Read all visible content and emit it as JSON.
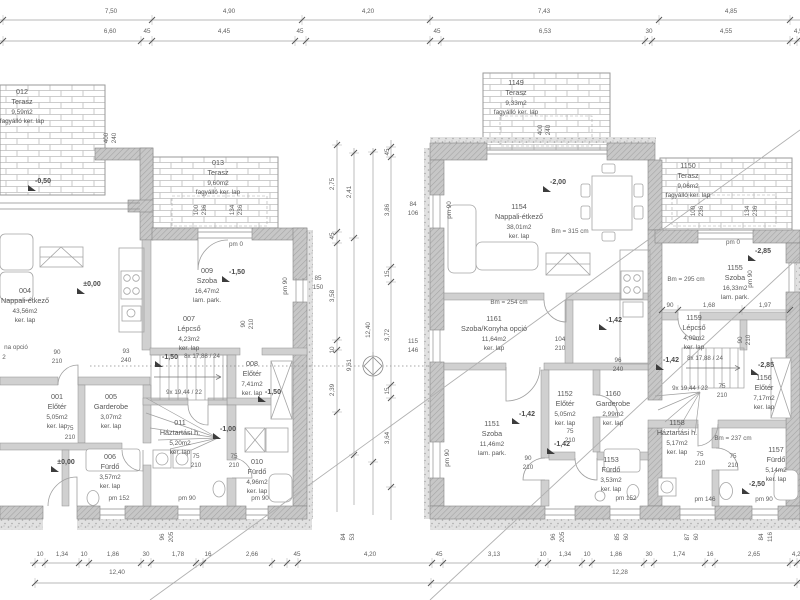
{
  "drawing_type": "architectural floor plan, two semi-detached houses, ground floor",
  "colors": {
    "paper": "#ffffff",
    "line": "#a0a0a0",
    "wall_fill": "#c9c9c9",
    "text": "#5f5f5f",
    "accent": "#3c3c3c"
  },
  "rooms": [
    {
      "id": "012",
      "name": "Terasz",
      "area": "9,59m2",
      "floor": "fagyálló ker. lap",
      "cx": 22,
      "y": 87
    },
    {
      "id": "013",
      "name": "Terasz",
      "area": "9,60m2",
      "floor": "fagyálló ker. lap",
      "cx": 218,
      "y": 158
    },
    {
      "id": "004",
      "name": "Nappali-étkező",
      "area": "43,56m2",
      "floor": "ker. lap",
      "cx": 25,
      "y": 286
    },
    {
      "id": "009",
      "name": "Szoba",
      "area": "16,47m2",
      "floor": "lam. park.",
      "cx": 207,
      "y": 266
    },
    {
      "id": "007",
      "name": "Lépcső",
      "area": "4,23m2",
      "floor": "ker. lap",
      "cx": 189,
      "y": 314
    },
    {
      "id": "008",
      "name": "Előtér",
      "area": "7,41m2",
      "floor": "ker. lap",
      "cx": 252,
      "y": 359
    },
    {
      "id": "001",
      "name": "Előtér",
      "area": "5,05m2",
      "floor": "ker. lap",
      "cx": 57,
      "y": 392
    },
    {
      "id": "005",
      "name": "Garderobe",
      "area": "3,07m2",
      "floor": "ker. lap",
      "cx": 111,
      "y": 392
    },
    {
      "id": "011",
      "name": "Háztartási h.",
      "area": "5,20m2",
      "floor": "ker. lap",
      "cx": 180,
      "y": 418
    },
    {
      "id": "006",
      "name": "Fürdő",
      "area": "3,57m2",
      "floor": "ker. lap",
      "cx": 110,
      "y": 452
    },
    {
      "id": "010",
      "name": "Fürdő",
      "area": "4,96m2",
      "floor": "ker. lap",
      "cx": 257,
      "y": 457
    },
    {
      "id": "1149",
      "name": "Terasz",
      "area": "9,33m2",
      "floor": "fagyálló ker. lap",
      "cx": 516,
      "y": 78
    },
    {
      "id": "1150",
      "name": "Terasz",
      "area": "9,06m2",
      "floor": "fagyálló ker. lap",
      "cx": 688,
      "y": 161
    },
    {
      "id": "1154",
      "name": "Nappali-étkező",
      "area": "38,01m2",
      "floor": "ker. lap",
      "cx": 519,
      "y": 202
    },
    {
      "id": "1161",
      "name": "Szoba/Konyha opció",
      "area": "11,64m2",
      "floor": "ker. lap",
      "cx": 494,
      "y": 314
    },
    {
      "id": "1151",
      "name": "Szoba",
      "area": "11,46m2",
      "floor": "lam. park.",
      "cx": 492,
      "y": 419
    },
    {
      "id": "1152",
      "name": "Előtér",
      "area": "5,05m2",
      "floor": "ker. lap",
      "cx": 565,
      "y": 389
    },
    {
      "id": "1160",
      "name": "Garderobe",
      "area": "2,99m2",
      "floor": "ker. lap",
      "cx": 613,
      "y": 389
    },
    {
      "id": "1153",
      "name": "Fürdő",
      "area": "3,53m2",
      "floor": "ker. lap",
      "cx": 611,
      "y": 455
    },
    {
      "id": "1155",
      "name": "Szoba",
      "area": "16,33m2",
      "floor": "lam. park.",
      "cx": 735,
      "y": 263
    },
    {
      "id": "1159",
      "name": "Lépcső",
      "area": "4,09m2",
      "floor": "ker. lap",
      "cx": 694,
      "y": 313
    },
    {
      "id": "1156",
      "name": "Előtér",
      "area": "7,17m2",
      "floor": "ker. lap",
      "cx": 764,
      "y": 373
    },
    {
      "id": "1158",
      "name": "Háztartási h.",
      "area": "5,17m2",
      "floor": "ker. lap",
      "cx": 677,
      "y": 418
    },
    {
      "id": "1157",
      "name": "Fürdő",
      "area": "5,14m2",
      "floor": "ker. lap",
      "cx": 776,
      "y": 445
    }
  ],
  "levels": [
    {
      "v": "-0,50",
      "x": 43,
      "y": 178
    },
    {
      "v": "±0,00",
      "x": 92,
      "y": 281
    },
    {
      "v": "-1,50",
      "x": 237,
      "y": 269
    },
    {
      "v": "-1,50",
      "x": 170,
      "y": 354
    },
    {
      "v": "-1,50",
      "x": 273,
      "y": 389
    },
    {
      "v": "-1,00",
      "x": 228,
      "y": 426
    },
    {
      "v": "±0,00",
      "x": 66,
      "y": 459
    },
    {
      "v": "-2,00",
      "x": 558,
      "y": 179
    },
    {
      "v": "-1,42",
      "x": 527,
      "y": 411
    },
    {
      "v": "-1,42",
      "x": 614,
      "y": 317
    },
    {
      "v": "-1,42",
      "x": 562,
      "y": 441
    },
    {
      "v": "-1,42",
      "x": 671,
      "y": 357
    },
    {
      "v": "-2,85",
      "x": 763,
      "y": 248
    },
    {
      "v": "-2,85",
      "x": 766,
      "y": 362
    },
    {
      "v": "-2,50",
      "x": 757,
      "y": 481
    }
  ],
  "dim_top1": {
    "y": 9,
    "items": [
      {
        "t": "7,50",
        "x": 111
      },
      {
        "t": "4,90",
        "x": 229
      },
      {
        "t": "4,20",
        "x": 368
      },
      {
        "t": "7,43",
        "x": 544
      },
      {
        "t": "4,85",
        "x": 731
      }
    ]
  },
  "dim_top2": {
    "y": 29,
    "items": [
      {
        "t": "6,60",
        "x": 110
      },
      {
        "t": "45",
        "x": 147
      },
      {
        "t": "4,45",
        "x": 224
      },
      {
        "t": "45",
        "x": 300
      },
      {
        "t": "45",
        "x": 437
      },
      {
        "t": "6,53",
        "x": 545
      },
      {
        "t": "30",
        "x": 649
      },
      {
        "t": "4,55",
        "x": 726
      },
      {
        "t": "4,55",
        "x": 800
      }
    ]
  },
  "dim_bottom": {
    "y": 552,
    "items": [
      {
        "t": "10",
        "x": 40
      },
      {
        "t": "1,34",
        "x": 62
      },
      {
        "t": "10",
        "x": 84
      },
      {
        "t": "1,86",
        "x": 113
      },
      {
        "t": "30",
        "x": 146
      },
      {
        "t": "1,78",
        "x": 178
      },
      {
        "t": "16",
        "x": 208
      },
      {
        "t": "2,66",
        "x": 252
      },
      {
        "t": "45",
        "x": 297
      },
      {
        "t": "4,20",
        "x": 370
      },
      {
        "t": "45",
        "x": 439
      },
      {
        "t": "3,13",
        "x": 494
      },
      {
        "t": "10",
        "x": 543
      },
      {
        "t": "1,34",
        "x": 565
      },
      {
        "t": "10",
        "x": 587
      },
      {
        "t": "1,86",
        "x": 616
      },
      {
        "t": "30",
        "x": 649
      },
      {
        "t": "1,74",
        "x": 679
      },
      {
        "t": "16",
        "x": 710
      },
      {
        "t": "2,65",
        "x": 754
      },
      {
        "t": "4,20",
        "x": 798
      }
    ]
  },
  "dim_totals": [
    {
      "t": "12,40",
      "x": 117,
      "y": 570
    },
    {
      "t": "12,28",
      "x": 620,
      "y": 570
    }
  ],
  "v_chains": [
    {
      "x": 333,
      "items": [
        {
          "t": "2,75",
          "y": 184
        },
        {
          "t": "45",
          "y": 236
        },
        {
          "t": "3,58",
          "y": 296
        },
        {
          "t": "10",
          "y": 350
        },
        {
          "t": "2,39",
          "y": 390
        }
      ]
    },
    {
      "x": 350,
      "items": [
        {
          "t": "2,41",
          "y": 192
        },
        {
          "t": "9,61",
          "y": 365
        }
      ]
    },
    {
      "x": 369,
      "items": [
        {
          "t": "12,40",
          "y": 330
        }
      ]
    },
    {
      "x": 388,
      "items": [
        {
          "t": "45",
          "y": 152
        },
        {
          "t": "3,86",
          "y": 210
        },
        {
          "t": "15",
          "y": 274
        },
        {
          "t": "3,72",
          "y": 335
        },
        {
          "t": "15",
          "y": 391
        },
        {
          "t": "3,64",
          "y": 438
        }
      ]
    }
  ],
  "annotations": [
    {
      "t": "8x 17,88 / 24",
      "x": 202,
      "y": 354
    },
    {
      "t": "9x 19,44 / 22",
      "x": 184,
      "y": 390
    },
    {
      "t": "8x 17,88 / 24",
      "x": 705,
      "y": 356
    },
    {
      "t": "9x 19,44 / 22",
      "x": 690,
      "y": 386
    },
    {
      "t": "Bm = 315 cm",
      "x": 570,
      "y": 229
    },
    {
      "t": "Bm = 254 cm",
      "x": 509,
      "y": 300
    },
    {
      "t": "Bm = 295 cm",
      "x": 686,
      "y": 277
    },
    {
      "t": "Bm = 237 cm",
      "x": 733,
      "y": 436
    },
    {
      "t": "pm  0",
      "x": 236,
      "y": 242
    },
    {
      "t": "pm  0",
      "x": 733,
      "y": 240
    },
    {
      "t": "pm  152",
      "x": 119,
      "y": 496
    },
    {
      "t": "pm  90",
      "x": 187,
      "y": 496
    },
    {
      "t": "pm  90",
      "x": 260,
      "y": 496
    },
    {
      "t": "pm  152",
      "x": 626,
      "y": 496
    },
    {
      "t": "pm  146",
      "x": 705,
      "y": 497
    },
    {
      "t": "pm  90",
      "x": 764,
      "y": 497
    },
    {
      "t": "pm 90",
      "x": 450,
      "y": 210,
      "rot": 1
    },
    {
      "t": "pm 90",
      "x": 448,
      "y": 458,
      "rot": 1
    },
    {
      "t": "pm 90",
      "x": 286,
      "y": 286,
      "rot": 1
    },
    {
      "t": "pm 90",
      "x": 751,
      "y": 279,
      "rot": 1
    },
    {
      "t": "90",
      "x": 57,
      "y": 350
    },
    {
      "t": "210",
      "x": 57,
      "y": 359
    },
    {
      "t": "75",
      "x": 70,
      "y": 426
    },
    {
      "t": "210",
      "x": 70,
      "y": 435
    },
    {
      "t": "75",
      "x": 196,
      "y": 454
    },
    {
      "t": "210",
      "x": 196,
      "y": 463
    },
    {
      "t": "75",
      "x": 234,
      "y": 454
    },
    {
      "t": "210",
      "x": 234,
      "y": 463
    },
    {
      "t": "93",
      "x": 126,
      "y": 349
    },
    {
      "t": "240",
      "x": 126,
      "y": 358
    },
    {
      "t": "96",
      "x": 618,
      "y": 358
    },
    {
      "t": "240",
      "x": 618,
      "y": 367
    },
    {
      "t": "104",
      "x": 560,
      "y": 337
    },
    {
      "t": "210",
      "x": 560,
      "y": 346
    },
    {
      "t": "85",
      "x": 318,
      "y": 276
    },
    {
      "t": "150",
      "x": 318,
      "y": 285
    },
    {
      "t": "84",
      "x": 413,
      "y": 202
    },
    {
      "t": "106",
      "x": 413,
      "y": 211
    },
    {
      "t": "115",
      "x": 413,
      "y": 339
    },
    {
      "t": "146",
      "x": 413,
      "y": 348
    },
    {
      "t": "75",
      "x": 570,
      "y": 429
    },
    {
      "t": "210",
      "x": 570,
      "y": 438
    },
    {
      "t": "90",
      "x": 528,
      "y": 456
    },
    {
      "t": "210",
      "x": 528,
      "y": 465
    },
    {
      "t": "75",
      "x": 700,
      "y": 452
    },
    {
      "t": "210",
      "x": 700,
      "y": 461
    },
    {
      "t": "75",
      "x": 733,
      "y": 454
    },
    {
      "t": "210",
      "x": 733,
      "y": 463
    },
    {
      "t": "75",
      "x": 722,
      "y": 384
    },
    {
      "t": "210",
      "x": 722,
      "y": 393
    },
    {
      "t": "90",
      "x": 741,
      "y": 340,
      "rot": 1
    },
    {
      "t": "210",
      "x": 749,
      "y": 340,
      "rot": 1
    },
    {
      "t": "90",
      "x": 244,
      "y": 324,
      "rot": 1
    },
    {
      "t": "210",
      "x": 252,
      "y": 324,
      "rot": 1
    },
    {
      "t": "400",
      "x": 107,
      "y": 138,
      "rot": 1
    },
    {
      "t": "240",
      "x": 115,
      "y": 138,
      "rot": 1
    },
    {
      "t": "400",
      "x": 541,
      "y": 130,
      "rot": 1
    },
    {
      "t": "240",
      "x": 549,
      "y": 130,
      "rot": 1
    },
    {
      "t": "100",
      "x": 197,
      "y": 210,
      "rot": 1
    },
    {
      "t": "236",
      "x": 205,
      "y": 210,
      "rot": 1
    },
    {
      "t": "134",
      "x": 233,
      "y": 210,
      "rot": 1
    },
    {
      "t": "236",
      "x": 241,
      "y": 210,
      "rot": 1
    },
    {
      "t": "100",
      "x": 694,
      "y": 211,
      "rot": 1
    },
    {
      "t": "236",
      "x": 702,
      "y": 211,
      "rot": 1
    },
    {
      "t": "134",
      "x": 748,
      "y": 211,
      "rot": 1
    },
    {
      "t": "236",
      "x": 756,
      "y": 211,
      "rot": 1
    },
    {
      "t": "96",
      "x": 163,
      "y": 537,
      "rot": 1
    },
    {
      "t": "205",
      "x": 172,
      "y": 537,
      "rot": 1
    },
    {
      "t": "84",
      "x": 344,
      "y": 537,
      "rot": 1
    },
    {
      "t": "53",
      "x": 353,
      "y": 537,
      "rot": 1
    },
    {
      "t": "96",
      "x": 554,
      "y": 537,
      "rot": 1
    },
    {
      "t": "205",
      "x": 563,
      "y": 537,
      "rot": 1
    },
    {
      "t": "85",
      "x": 618,
      "y": 537,
      "rot": 1
    },
    {
      "t": "60",
      "x": 627,
      "y": 537,
      "rot": 1
    },
    {
      "t": "87",
      "x": 688,
      "y": 537,
      "rot": 1
    },
    {
      "t": "60",
      "x": 697,
      "y": 537,
      "rot": 1
    },
    {
      "t": "84",
      "x": 762,
      "y": 537,
      "rot": 1
    },
    {
      "t": "116",
      "x": 771,
      "y": 537,
      "rot": 1
    },
    {
      "t": "na opció",
      "x": 16,
      "y": 345
    },
    {
      "t": "2",
      "x": 4,
      "y": 355
    },
    {
      "t": "90",
      "x": 670,
      "y": 303
    },
    {
      "t": "1,68",
      "x": 709,
      "y": 303
    },
    {
      "t": "1,97",
      "x": 765,
      "y": 303
    }
  ]
}
